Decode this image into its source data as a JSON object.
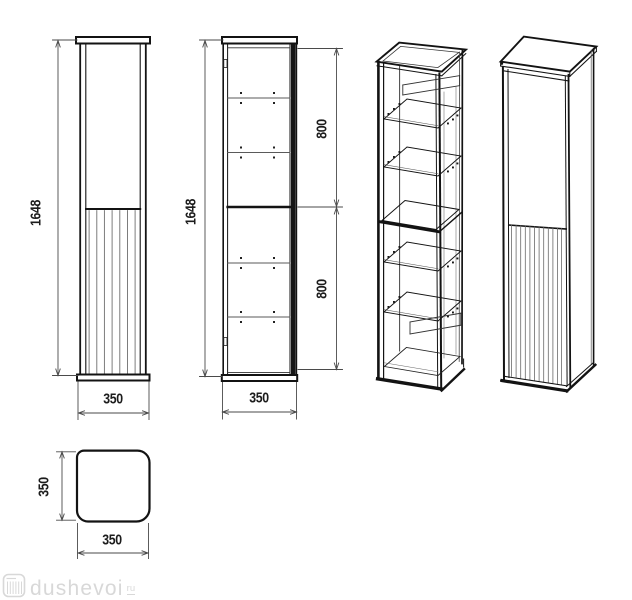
{
  "drawing": {
    "front_closed": {
      "height": "1648",
      "width": "350"
    },
    "front_open": {
      "height": "1648",
      "width": "350",
      "upper": "800",
      "lower": "800"
    },
    "top_view": {
      "depth": "350",
      "width": "350"
    },
    "colors": {
      "outline": "#131313",
      "dimension_line": "#4a4a4a",
      "slat_line": "#6f6f6f",
      "shelf_line": "#5a5a5a",
      "background": "#ffffff"
    }
  },
  "watermark": {
    "site": "dushevoi",
    "tld": "ru",
    "icon": "shower-cabin-icon",
    "color": "#d8d8d8"
  }
}
